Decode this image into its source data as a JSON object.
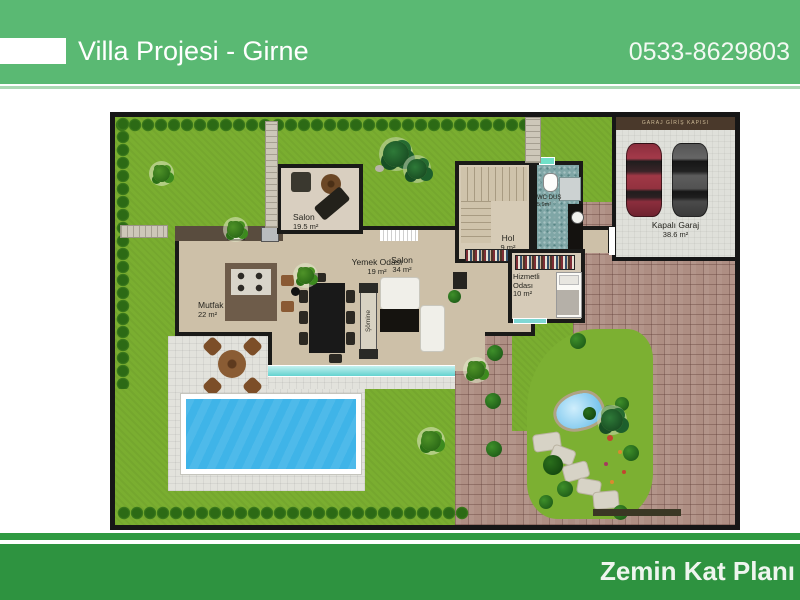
{
  "header": {
    "title": "Villa Projesi - Girne",
    "phone": "0533-8629803"
  },
  "footer": {
    "title": "Zemin Kat Planı"
  },
  "plan": {
    "rooms": {
      "salon_upper": {
        "name": "Salon",
        "area": "19.5 m²"
      },
      "mutfak": {
        "name": "Mutfak",
        "area": "22 m²"
      },
      "yemek": {
        "name": "Yemek Odası",
        "area": "19 m²"
      },
      "salon_main": {
        "name": "Salon",
        "area": "34 m²"
      },
      "hol": {
        "name": "Hol",
        "area": "9 m²"
      },
      "wc": {
        "name": "WC DUŞ",
        "area": "5,9m²"
      },
      "hizmetli": {
        "name": "Hizmetli Odası",
        "area": "10 m²"
      },
      "garaj": {
        "name": "Kapalı Garaj",
        "area": "38.6 m²"
      }
    },
    "labels": {
      "fireplace": "Şömine",
      "garage_door": "GARAJ GİRİŞ KAPISI"
    },
    "colors": {
      "header_green": "#5ab973",
      "footer_green": "#2e9340",
      "grass": "#7aae30",
      "pool_water": "#3fb4e8",
      "driveway": "#ae8e83",
      "window_teal": "#7fd8d4",
      "car_left": "#8e2f3e",
      "car_right": "#474747"
    }
  }
}
